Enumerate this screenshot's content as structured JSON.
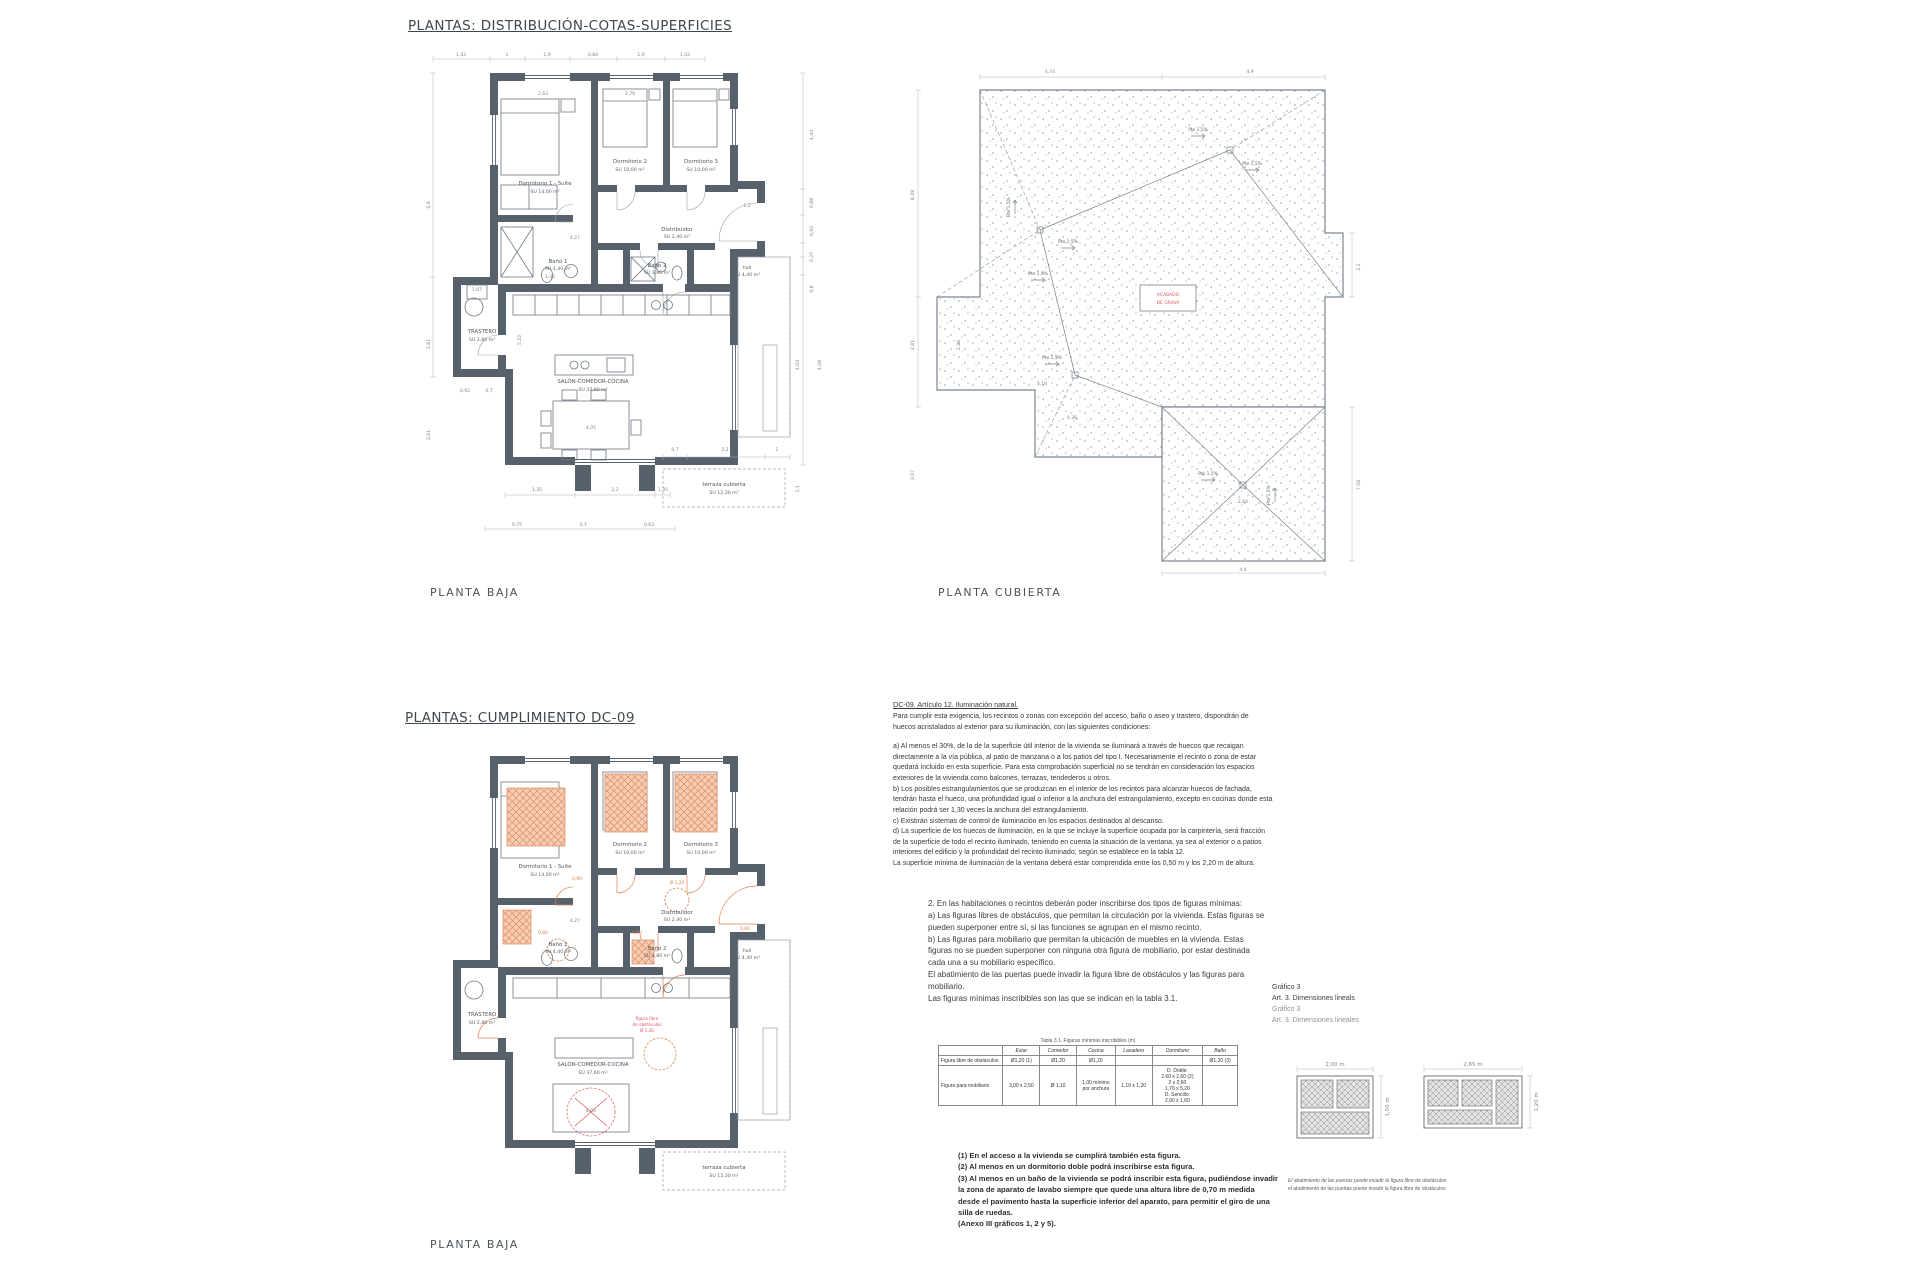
{
  "section1": {
    "title": "PLANTAS: DISTRIBUCIÓN-COTAS-SUPERFICIES"
  },
  "section2": {
    "title": "PLANTAS: CUMPLIMIENTO DC-09"
  },
  "plan_baja": {
    "label": "PLANTA BAJA",
    "rooms": {
      "dorm1": {
        "name": "Dormitorio 1 - Suite",
        "area": "SU 14,00 m²"
      },
      "dorm2": {
        "name": "Dormitorio 2",
        "area": "SU 10,00 m²"
      },
      "dorm3": {
        "name": "Dormitorio 3",
        "area": "SU 10,00 m²"
      },
      "distribuidor": {
        "name": "Distribuidor",
        "area": "SU 2,40 m²"
      },
      "bano1": {
        "name": "Baño 1",
        "area": "SU 4,40 m²"
      },
      "bano2": {
        "name": "Baño 2",
        "area": "SU 3,80 m²"
      },
      "hall": {
        "name": "hall",
        "area": "SU 4,40 m²"
      },
      "trastero": {
        "name": "TRASTERO",
        "area": "SU 2,80 m²"
      },
      "salon": {
        "name": "SALÓN-COMEDOR-COCINA",
        "area": "SU 37,60 m²"
      },
      "terraza": {
        "name": "terraza cubierta",
        "area": "SU 12,30 m²"
      }
    },
    "dims": {
      "top": [
        "1,42",
        "1",
        "1,9",
        "0,84",
        "1,9",
        "1,02"
      ],
      "inner_top": [
        "2,63",
        "2,79"
      ],
      "left": [
        "6,9",
        "2,81",
        "2,61"
      ],
      "right": [
        "4,44",
        "0,88",
        "0,92",
        "0,25",
        "0,8",
        "4,08",
        "4,04"
      ],
      "bottom": [
        "1,35",
        "2,2",
        "1,35",
        "0,75",
        "3,7",
        "0,63"
      ],
      "terraza": [
        "0,7",
        "2,2",
        "1",
        "2,1"
      ],
      "inner": [
        "4,27",
        "1,42",
        "1,67",
        "4,05",
        "0,92",
        "0,7",
        "5,22",
        "1,2"
      ]
    }
  },
  "plan_cubierta": {
    "label": "PLANTA CUBIERTA",
    "slope_label": "Pte 1,5%",
    "legend": [
      "ACABADO",
      "DE GRAVA"
    ],
    "dims": {
      "top": [
        "4,74",
        "4,9"
      ],
      "left": [
        "8,28",
        "2,81",
        "3,07",
        "2,26"
      ],
      "right": [
        "2,2",
        "7,58"
      ],
      "bottom": [
        "4,36",
        "4,4"
      ],
      "inner": [
        "5,18",
        "2,64"
      ]
    }
  },
  "plan_dc09": {
    "label": "PLANTA BAJA",
    "red_note": [
      "figura libre",
      "de obstáculos",
      "Ø 1,20"
    ],
    "orange_dims": [
      "0,80",
      "0,80",
      "0,90",
      "0,60",
      "Ø 1,20"
    ],
    "inner_dims": [
      "4,27",
      "4,05"
    ]
  },
  "dc09_text": {
    "title": "DC-09. Artículo 12. Iluminación natural.",
    "paragraphs": [
      "Para cumplir esta exigencia, los recintos o zonas con excepción del acceso, baño o aseo y trastero, dispondrán de huecos acristalados al exterior para su iluminación, con las siguientes condiciones:",
      "a) Al menos el 30%, de la de la superficie útil interior de la vivienda se iluminará a través de huecos que recaigan directamente a la vía pública, al patio de manzana o a los patios del tipo I. Necesariamente el recinto o zona de estar quedará incluido en esta superficie. Para esta comprobación superficial no se tendrán en consideración los espacios exteriores de la vivienda como balcones, terrazas, tendederos u otros.",
      "b) Los posibles estrangulamientos que se produzcan en el interior de los recintos para alcanzar huecos de fachada, tendrán hasta el hueco, una profundidad igual o inferior a la anchura del estrangulamiento, excepto en cocinas donde esta relación podrá ser 1,30 veces la anchura del estrangulamiento.",
      "c) Existirán sistemas de control de iluminación en los espacios destinados al descanso.",
      "d) La superficie de los huecos de iluminación, en la que se incluye la superficie ocupada por la carpintería, será fracción de la superficie de todo el recinto iluminado, teniendo en cuenta la situación de la ventana, ya sea al exterior o a patios interiores del edificio y la profundidad del recinto iluminado, según se establece en la tabla 12.",
      "La superficie mínima de iluminación de la ventana deberá estar comprendida entre los 0,50 m y los 2,20 m de altura."
    ]
  },
  "figuras_text": {
    "paragraphs": [
      "2. En las habitaciones o recintos deberán poder inscribirse dos tipos de figuras mínimas:",
      "a) Las figuras libres de obstáculos, que permitan la circulación por la vivienda. Estas figuras se pueden superponer entre sí, si las funciones se agrupan en el mismo recinto.",
      "b) Las figuras para mobiliario que permitan la ubicación de muebles en la vivienda. Estas figuras no se pueden superponer con ninguna otra figura de mobiliario, por estar destinada cada una a su mobiliario específico.",
      "El abatimiento de las puertas puede invadir la figura libre de obstáculos y las figuras para mobiliario.",
      "Las figuras mínimas inscribibles son las que se indican en la tabla 3.1."
    ]
  },
  "tabla": {
    "caption": "Tabla 3.1. Figuras mínimas inscribibles (m)",
    "headers": [
      "",
      "Estar",
      "Comedor",
      "Cocina",
      "Lavadero",
      "Dormitorio",
      "Baño"
    ],
    "rows": [
      {
        "label": "Figura libre de obstáculos",
        "cells": [
          "Ø1,20 (1)",
          "Ø1,20",
          "Ø1,20",
          "",
          "",
          "Ø1,20 (3)"
        ]
      },
      {
        "label": "Figura para mobiliario",
        "cells": [
          "3,00 x 2,50",
          "Ø 1,10",
          "1,00 mínimo por anchura",
          "1,10 x 1,20",
          "D. Doble:\n2,60 x 2,60 (2)\n2 x 2,60\n1,70 x 5,20\nD. Sencillo:\n2,90 x 1,60",
          ""
        ]
      }
    ]
  },
  "grafico3": {
    "lines": [
      "Gráfico 3",
      "Art. 3. Dimensiones lineals",
      "Gráfico 3",
      "Art. 3. Dimensiones lineales"
    ],
    "diagram1": {
      "width_label": "2,00 m",
      "height_label": "1,50 m"
    },
    "diagram2": {
      "width_label": "2,65 m",
      "height_label": "1,20 m"
    },
    "caption": [
      "El abatimiento de las puertas puede invadir la figura libre de obstáculos",
      "el abatimiento de las puertas puede invadir la figura libre de obstáculos"
    ]
  },
  "notes": {
    "lines": [
      "(1) En el acceso a la vivienda se cumplirá también esta figura.",
      "(2) Al menos en un dormitorio doble podrá inscribirse esta figura.",
      "(3) Al menos en un baño de la vivienda se podrá inscribir esta figura, pudiéndose invadir la zona de aparato de lavabo siempre que quede una altura libre de 0,70 m medida desde el pavimento hasta la superficie inferior del aparato, para permitir el giro de una silla de ruedas.",
      "(Anexo III gráficos 1, 2 y 5)."
    ]
  },
  "colors": {
    "wall": "#57616b",
    "line": "#6e7882",
    "dim": "#7d8792",
    "orange": "#e2906b",
    "red": "#e05252",
    "pink": "#e34f6b"
  }
}
